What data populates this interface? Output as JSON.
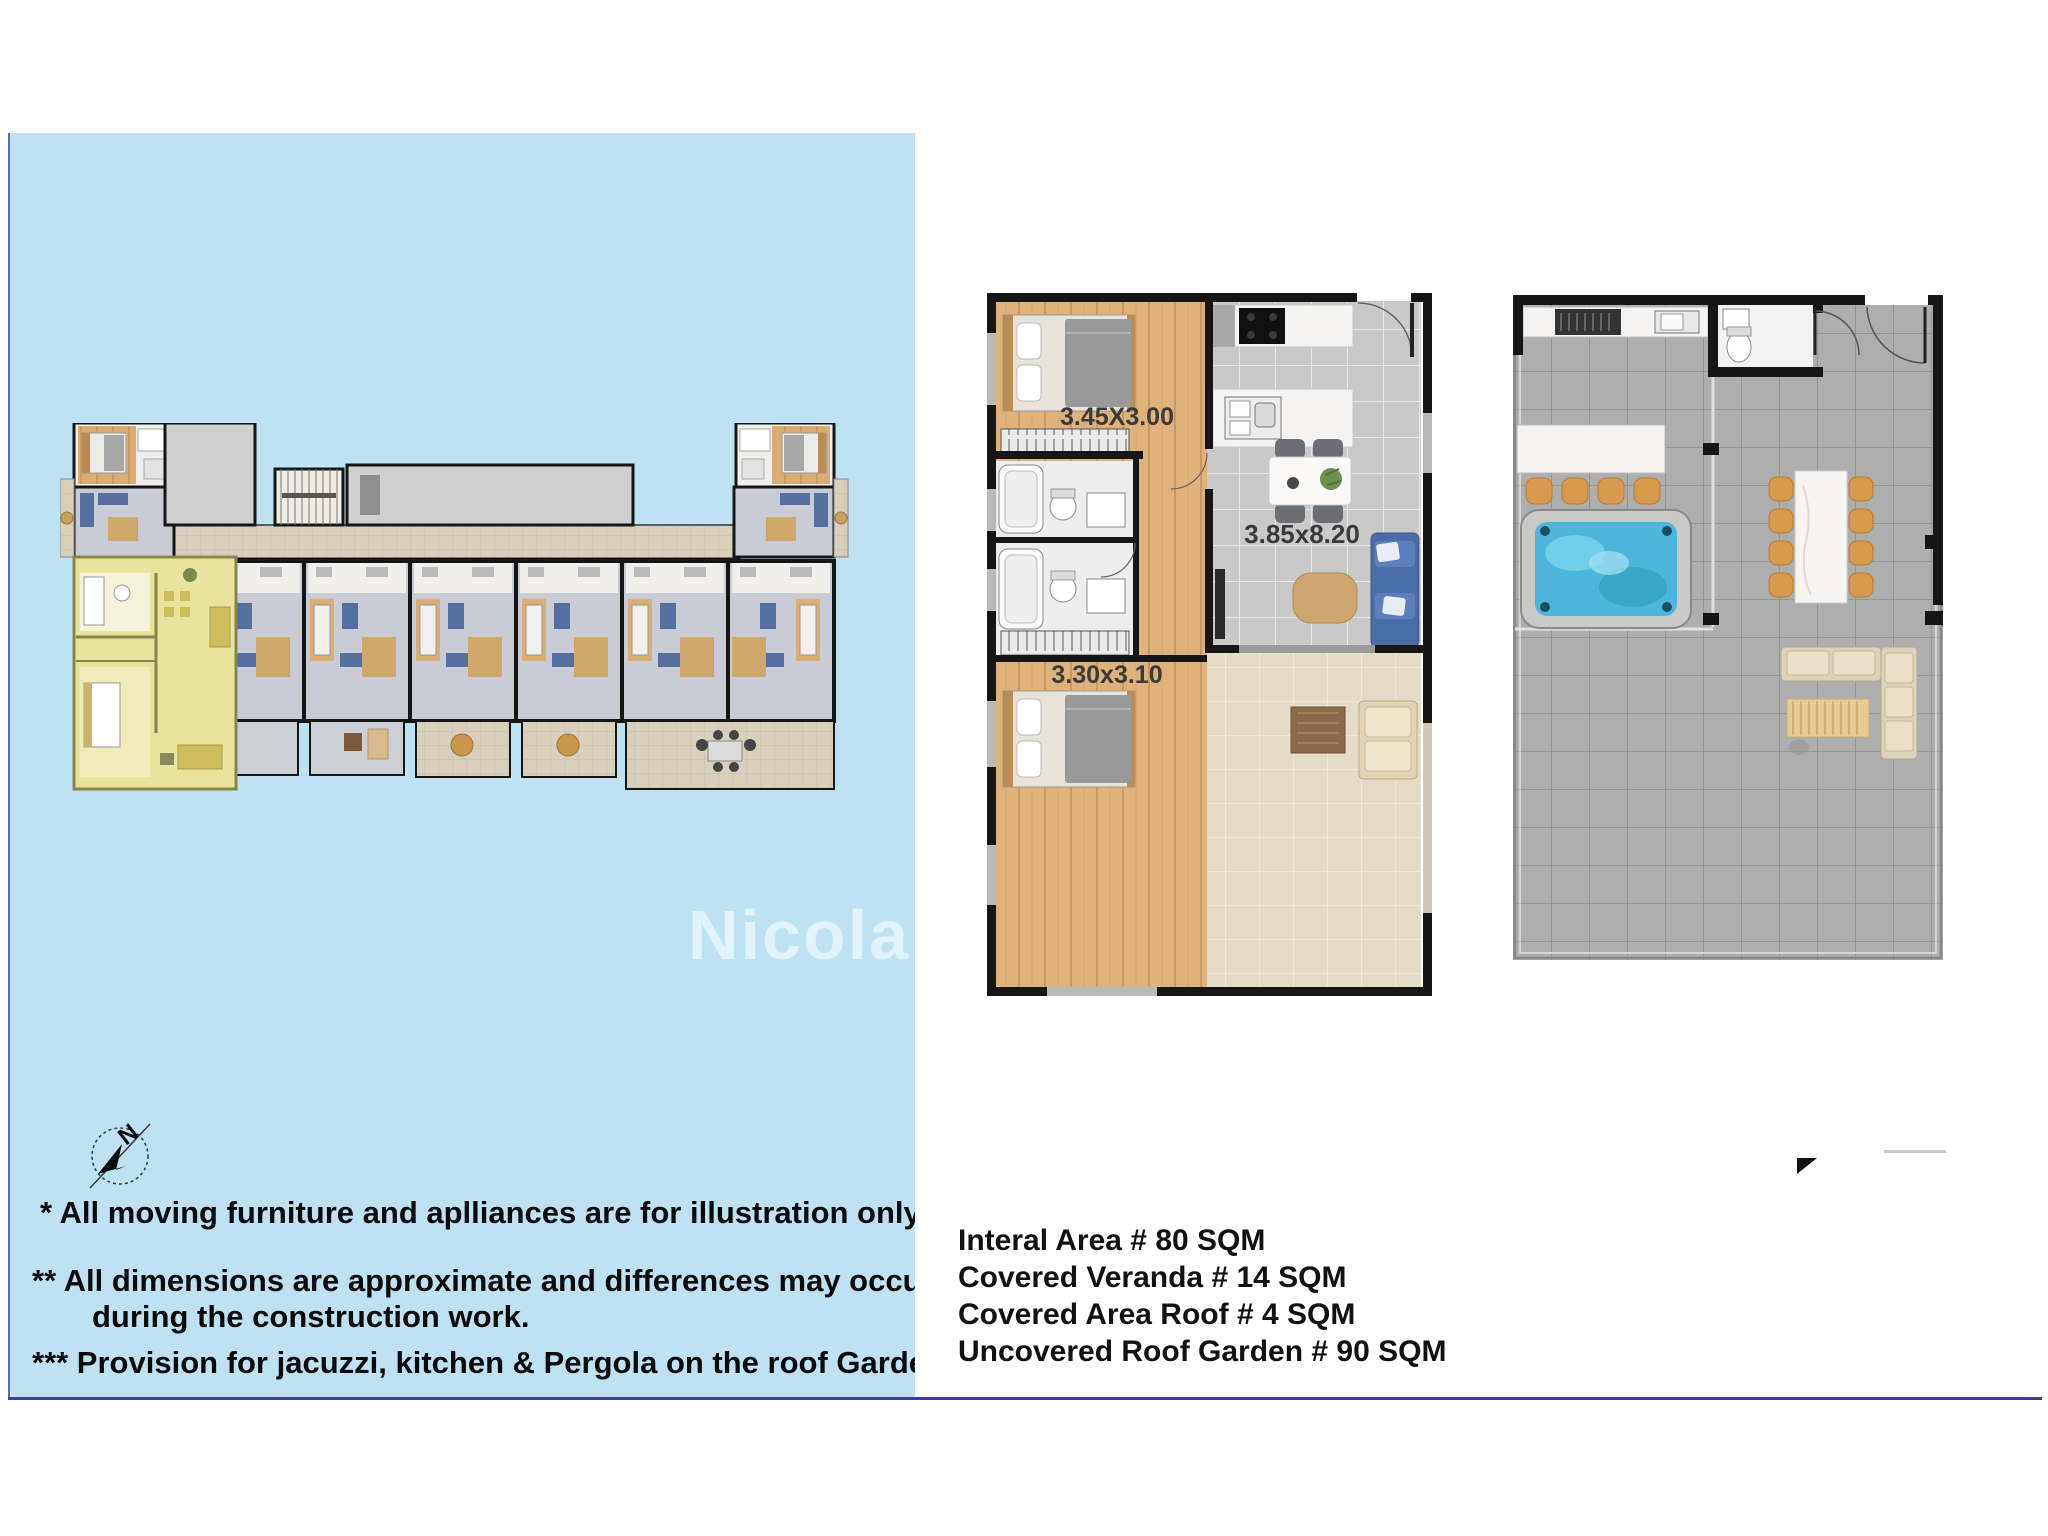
{
  "page": {
    "background": "#ffffff",
    "divider_color": "#3c3f99"
  },
  "left_panel": {
    "background": "#bfe2f2",
    "top_fragment": "·· ···· ·· ·····",
    "watermark": "Nicola",
    "compass": {
      "label": "N"
    },
    "disclaimers": [
      "* All moving furniture and aplliances are for illustration only.",
      "** All dimensions are approximate and differences may occur",
      "during the construction work.",
      "*** Provision for jacuzzi, kitchen & Pergola on the roof Garden"
    ]
  },
  "unit_plan": {
    "bedroom1_dim": "3.45X3.00",
    "living_dim": "3.85x8.20",
    "bedroom2_dim": "3.30x3.10"
  },
  "areas": {
    "lines": [
      "Interal Area # 80 SQM",
      "Covered Veranda # 14 SQM",
      "Covered Area Roof # 4 SQM",
      "Uncovered Roof Garden # 90 SQM"
    ]
  },
  "colors": {
    "panel_blue": "#bfe2f2",
    "highlight_yellow": "#e9e49c",
    "wood": "#dfb27c",
    "sofa_blue": "#4a6da8",
    "jacuzzi_blue": "#4db6dc",
    "wall_black": "#161616"
  }
}
